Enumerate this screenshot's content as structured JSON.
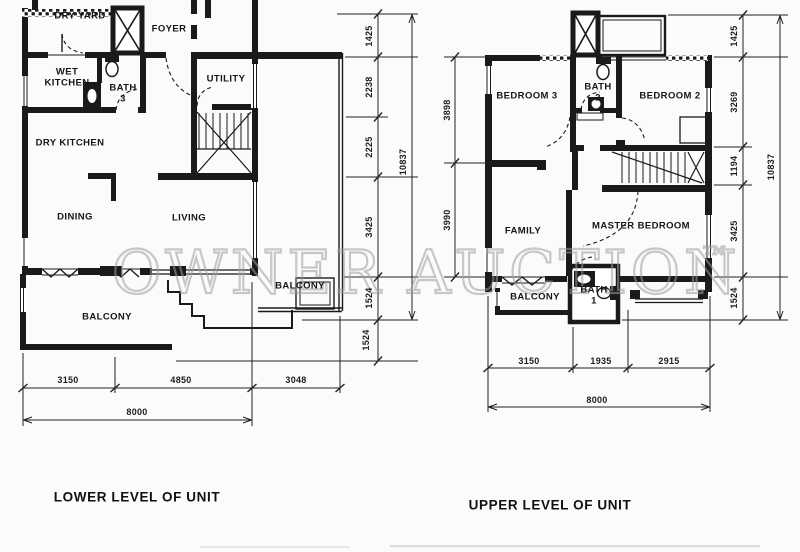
{
  "watermark": {
    "text": "OWNER AUCTION",
    "tm": "™"
  },
  "lower": {
    "title": "LOWER LEVEL OF UNIT",
    "rooms": {
      "dry_yard": "DRY YARD",
      "foyer": "FOYER",
      "wet_kitchen": "WET KITCHEN",
      "bath3": "BATH 3",
      "utility": "UTILITY",
      "dry_kitchen": "DRY KITCHEN",
      "dining": "DINING",
      "living": "LIVING",
      "balcony_right": "BALCONY",
      "balcony_bottom": "BALCONY"
    },
    "dims": {
      "right": {
        "d1": "1425",
        "d2": "2238",
        "d3": "2225",
        "d4": "3425",
        "d5": "1524",
        "d6": "1524",
        "overall": "10837"
      },
      "bottom": {
        "d1": "3150",
        "d2": "4850",
        "d3": "3048",
        "overall": "8000"
      }
    }
  },
  "upper": {
    "title": "UPPER LEVEL OF UNIT",
    "rooms": {
      "bedroom3": "BEDROOM 3",
      "bath2": "BATH 2",
      "bedroom2": "BEDROOM 2",
      "family": "FAMILY",
      "master_bedroom": "MASTER BEDROOM",
      "balcony": "BALCONY",
      "bath1": "BATH 1"
    },
    "dims": {
      "left": {
        "d1": "3898",
        "d2": "3990"
      },
      "right": {
        "d1": "1425",
        "d2": "3269",
        "d3": "1194",
        "d4": "3425",
        "d5": "1524",
        "overall": "10837"
      },
      "bottom": {
        "d1": "3150",
        "d2": "1935",
        "d3": "2915",
        "overall": "8000"
      }
    }
  }
}
